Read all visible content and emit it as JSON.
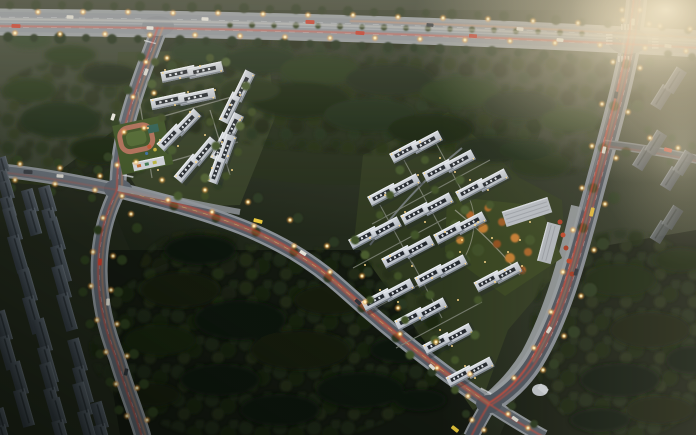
{
  "page": {
    "title": "Aerial dusk rendering of a residential development masterplan",
    "alt": "Bird's-eye architectural visualization at dusk: two clusters of new white apartment slab blocks, existing dark housing blocks to the southwest and east, dense tree masses, and a road network with glowing yellow street lamps, red-orange traffic light trails and a warm sunset haze in the upper right."
  },
  "scene": {
    "type": "aerial-architectural-rendering",
    "time_of_day": "dusk",
    "camera": "bird's-eye oblique",
    "west_cluster": {
      "label": "West residential cluster",
      "building_count": 7,
      "building_style": "white mid-rise slab blocks with dark rooftop cores",
      "amenities": [
        "kindergarten with red running track",
        "landscaped courtyards"
      ]
    },
    "east_cluster": {
      "label": "East residential cluster",
      "building_count": 14,
      "building_style": "white mid-rise slab blocks with dark rooftop cores",
      "amenities": [
        "central landscaped garden with autumn trees",
        "community commercial center along east road",
        "south entrance plaza"
      ]
    },
    "existing_southwest": {
      "label": "Existing housing blocks (southwest)",
      "building_count": 15,
      "building_style": "dark gray slab blocks"
    },
    "existing_east": {
      "label": "Existing blocks (east edge)",
      "building_count": 4,
      "building_style": "gray slab blocks in haze"
    },
    "roads": [
      {
        "id": "highway-north",
        "label": "East-west arterial highway along the top"
      },
      {
        "id": "road-east-curved",
        "label": "North-south arterial curving along the east cluster"
      },
      {
        "id": "road-central-diagonal",
        "label": "Diagonal connector between the two clusters"
      },
      {
        "id": "road-west-diagonal",
        "label": "Diagonal road from the north junction"
      },
      {
        "id": "road-south",
        "label": "Southern continuation past the existing blocks"
      },
      {
        "id": "road-west-spur",
        "label": "Western spur to the image edge"
      },
      {
        "id": "road-east-spur",
        "label": "Minor spur at the east edge"
      }
    ],
    "junctions": [
      {
        "id": "north-junction"
      },
      {
        "id": "northeast-crossroads"
      },
      {
        "id": "west-junction"
      },
      {
        "id": "south-junction"
      }
    ],
    "lighting": {
      "street_lamps": "warm yellow points along all roads",
      "traffic": "red-orange tail-light trails and white headlights",
      "ambient": "warm sunset haze strongest in the upper right",
      "windows": "scattered warm lights inside the clusters"
    },
    "vegetation": {
      "forest": "dense dark tree masses surrounding the site",
      "garden": "autumn orange and green ornamental trees in the east garden"
    }
  },
  "colors": {
    "ground_light": "#3a4030",
    "ground_mid": "#272e1f",
    "ground_dark": "#121710",
    "forest_dark": "#1a2413",
    "forest_deep": "#10150c",
    "canopy": "#2c3a1e",
    "canopy_light": "#43552a",
    "highway_asphalt": "#878d94",
    "road_asphalt": "#59616b",
    "east_asphalt": "#4a525c",
    "sidewalk": "#9aa0a6",
    "sidewalk_minor": "#8a9096",
    "lane_mark": "#c4c9ce",
    "new_wall": "#cdd2d9",
    "new_wall_hl": "#eef1f5",
    "new_roof": "#23282e",
    "facade_shadow": "#79818b",
    "old_wall": "#525b64",
    "old_wall_dark": "#31383f",
    "old_east_wall": "#6a717a",
    "commercial_roof": "#b6bbc2",
    "lamp_core": "#fff1c2",
    "lamp_glow": "#ffc84a",
    "window_light": "#ffd98a",
    "trail_red": "#e8432e",
    "trail_orange": "#ff8a46",
    "trail_yellow": "#e8c66a",
    "headlight": "#e3e1d6",
    "haze": "#e6d6b4",
    "garden_green": "#36431f",
    "autumn_orange": "#bf7a2f",
    "autumn_red": "#b03a24",
    "track_red": "#ad6d57",
    "field_green": "#3c5124",
    "infield_green": "#4e6630"
  }
}
